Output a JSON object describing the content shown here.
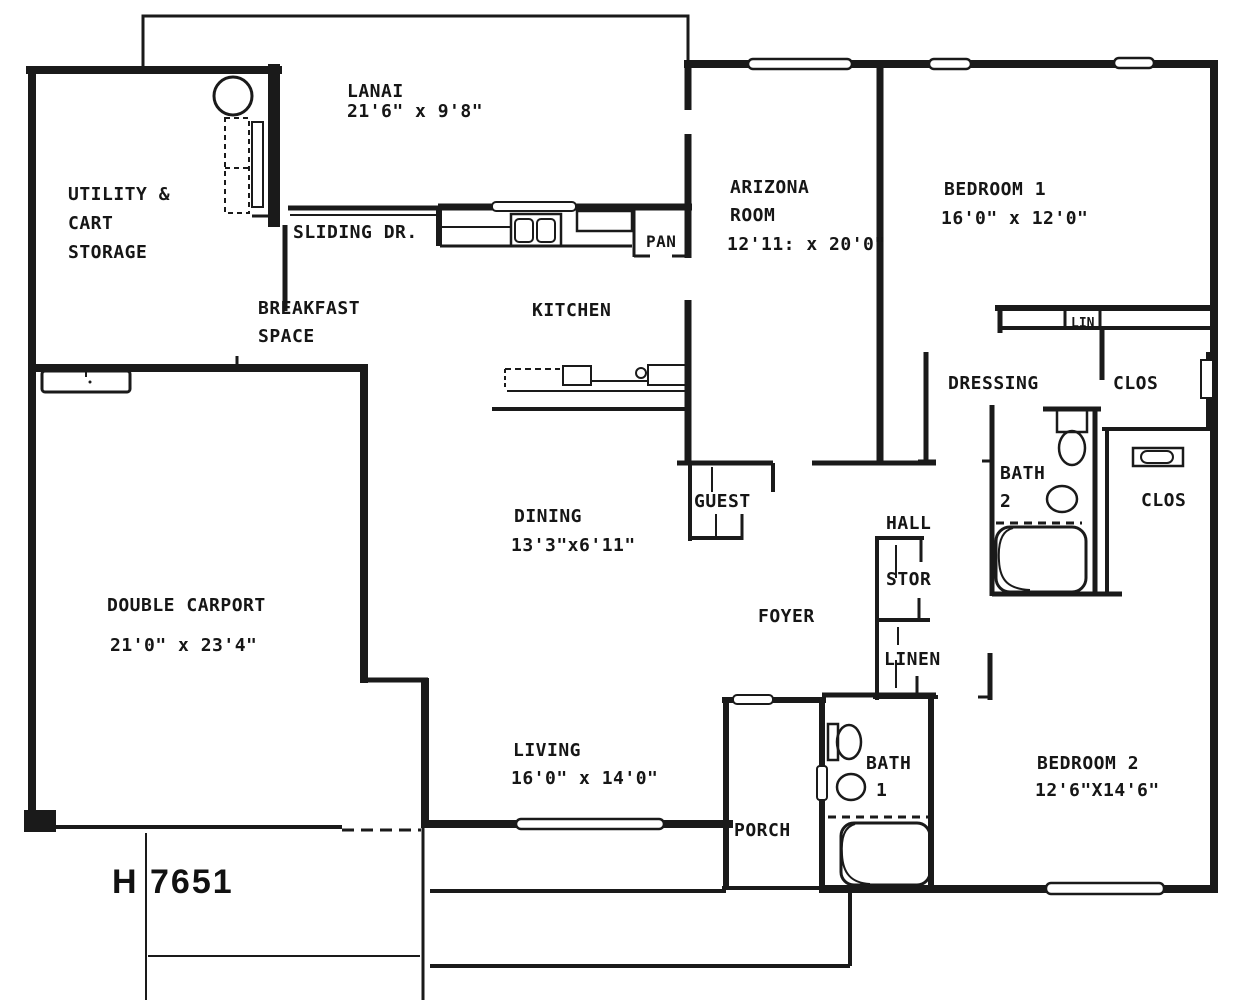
{
  "plan": {
    "number": "H 7651",
    "rooms": {
      "lanai": {
        "name": "LANAI",
        "dims": "21'6\" x 9'8\""
      },
      "utility": {
        "line1": "UTILITY &",
        "line2": "CART",
        "line3": "STORAGE"
      },
      "sliding_door": {
        "label": "SLIDING DR."
      },
      "breakfast": {
        "line1": "BREAKFAST",
        "line2": "SPACE"
      },
      "kitchen": {
        "name": "KITCHEN"
      },
      "pantry": {
        "abbr": "PAN"
      },
      "arizona_room": {
        "line1": "ARIZONA",
        "line2": "ROOM",
        "dims": "12'11: x 20'0\""
      },
      "bedroom1": {
        "name": "BEDROOM 1",
        "dims": "16'0\" x 12'0\""
      },
      "linen_cabinet": {
        "abbr": "LIN"
      },
      "dressing": {
        "name": "DRESSING"
      },
      "closet_bedroom1": {
        "abbr": "CLOS"
      },
      "bath2": {
        "line1": "BATH",
        "line2": "2"
      },
      "closet_bedroom2": {
        "abbr": "CLOS"
      },
      "guest_closet": {
        "name": "GUEST"
      },
      "hall": {
        "name": "HALL"
      },
      "storage_closet": {
        "abbr": "STOR"
      },
      "foyer": {
        "name": "FOYER"
      },
      "linen_closet": {
        "name": "LINEN"
      },
      "dining": {
        "name": "DINING",
        "dims": "13'3\"x6'11\""
      },
      "carport": {
        "name": "DOUBLE CARPORT",
        "dims": "21'0\" x 23'4\""
      },
      "living": {
        "name": "LIVING",
        "dims": "16'0\" x 14'0\""
      },
      "bath1": {
        "line1": "BATH",
        "line2": "1"
      },
      "porch": {
        "name": "PORCH"
      },
      "bedroom2": {
        "name": "BEDROOM 2",
        "dims": "12'6\"X14'6\""
      }
    }
  }
}
